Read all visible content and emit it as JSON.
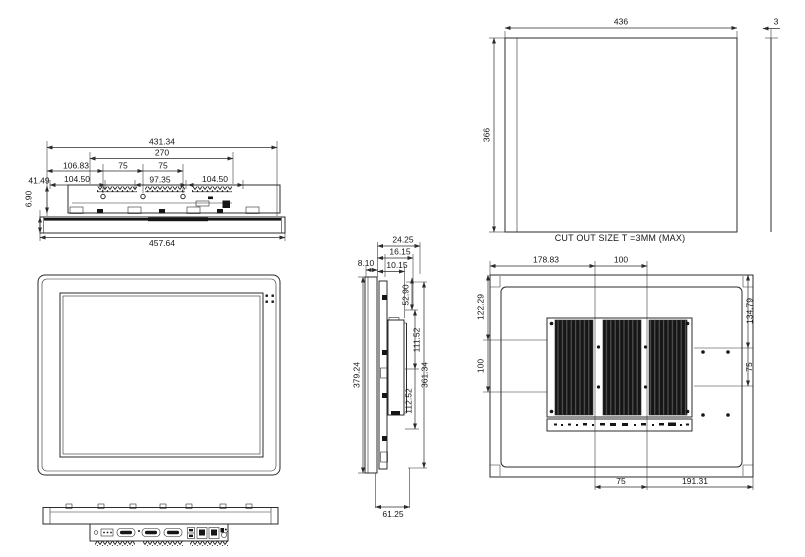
{
  "colors": {
    "line": "#2b2b2b",
    "background": "#ffffff",
    "heatsink": "#161616"
  },
  "top_view": {
    "overall_width": "457.64",
    "body_width": "431.34",
    "module_width": "270",
    "offset_left": "106.83",
    "hole_pitch_1": "75",
    "hole_pitch_2": "75",
    "seg_left": "104.50",
    "seg_center": "97.35",
    "seg_right": "104.50",
    "depth": "41.49",
    "bezel_thickness": "6.90"
  },
  "cutout_view": {
    "width": "436",
    "height": "366",
    "thickness": "3",
    "note": "CUT OUT SIZE T =3MM (MAX)"
  },
  "side_view": {
    "depth_step_1": "24.25",
    "depth_step_2": "16.15",
    "depth_front": "8.10",
    "depth_back": "10.15",
    "height_top": "52.90",
    "height_box_upper": "111.52",
    "height_box_lower": "112.52",
    "height_rear": "361.34",
    "height_total": "379.24",
    "depth_total": "61.25"
  },
  "rear_view": {
    "top_left": "178.83",
    "top_right": "100",
    "left_upper": "122.29",
    "left_lower": "100",
    "right_upper": "134.79",
    "right_lower": "75",
    "bottom_left": "75",
    "bottom_right": "191.31"
  }
}
